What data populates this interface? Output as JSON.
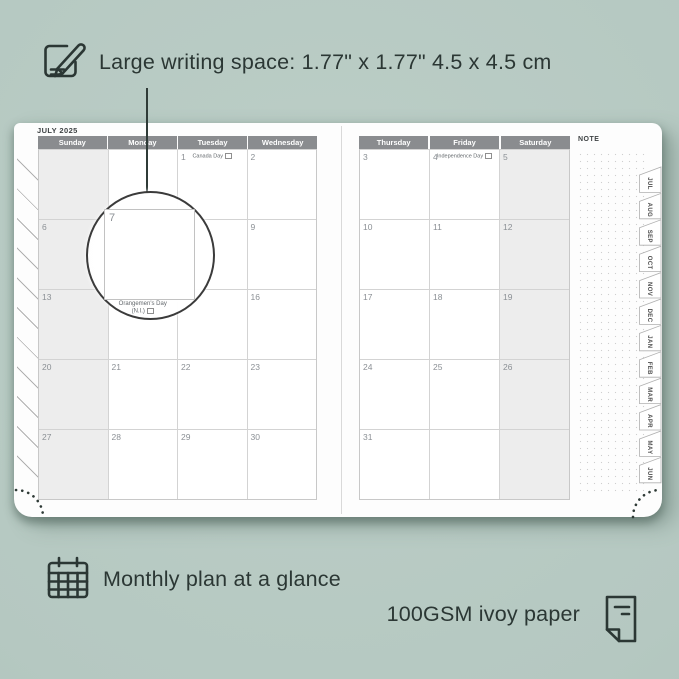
{
  "annotations": {
    "top_text": "Large writing space: 1.77\" x 1.77\"  4.5 x 4.5 cm",
    "bottom_left_text": "Monthly plan at a glance",
    "bottom_right_text": "100GSM ivoy paper"
  },
  "colors": {
    "background": "#b5c8c1",
    "ink": "#2b3734",
    "header_gray": "#8a8c8f",
    "weekend_shade": "#ededed",
    "page_white": "#fdfdfd"
  },
  "planner": {
    "month_title": "JULY 2025",
    "note_label": "NOTE",
    "tabs": [
      "JUL",
      "AUG",
      "SEP",
      "OCT",
      "NOV",
      "DEC",
      "JAN",
      "FEB",
      "MAR",
      "APR",
      "MAY",
      "JUN"
    ],
    "left_page": {
      "headers": [
        "Sunday",
        "Monday",
        "Tuesday",
        "Wednesday"
      ],
      "rows": [
        [
          {
            "shaded": true
          },
          {},
          {
            "day": "1",
            "holiday": "Canada Day",
            "flag": true
          },
          {
            "day": "2"
          }
        ],
        [
          {
            "day": "6",
            "shaded": true
          },
          {
            "day": "7"
          },
          {
            "day": "8"
          },
          {
            "day": "9"
          }
        ],
        [
          {
            "day": "13",
            "shaded": true
          },
          {
            "day": "14",
            "holiday": "Orangemen's Day",
            "holiday2": "(N.I.)",
            "flag": true,
            "callout": true
          },
          {
            "day": "15"
          },
          {
            "day": "16"
          }
        ],
        [
          {
            "day": "20",
            "shaded": true
          },
          {
            "day": "21"
          },
          {
            "day": "22"
          },
          {
            "day": "23"
          }
        ],
        [
          {
            "day": "27",
            "shaded": true
          },
          {
            "day": "28"
          },
          {
            "day": "29"
          },
          {
            "day": "30"
          }
        ]
      ]
    },
    "right_page": {
      "headers": [
        "Thursday",
        "Friday",
        "Saturday"
      ],
      "rows": [
        [
          {
            "day": "3"
          },
          {
            "day": "4",
            "holiday": "Independence Day",
            "flag": true
          },
          {
            "day": "5",
            "shaded": true
          }
        ],
        [
          {
            "day": "10"
          },
          {
            "day": "11"
          },
          {
            "day": "12",
            "shaded": true
          }
        ],
        [
          {
            "day": "17"
          },
          {
            "day": "18"
          },
          {
            "day": "19",
            "shaded": true
          }
        ],
        [
          {
            "day": "24"
          },
          {
            "day": "25"
          },
          {
            "day": "26",
            "shaded": true
          }
        ],
        [
          {
            "day": "31"
          },
          {},
          {
            "shaded": true
          }
        ]
      ]
    },
    "magnifier": {
      "day": "7"
    }
  }
}
